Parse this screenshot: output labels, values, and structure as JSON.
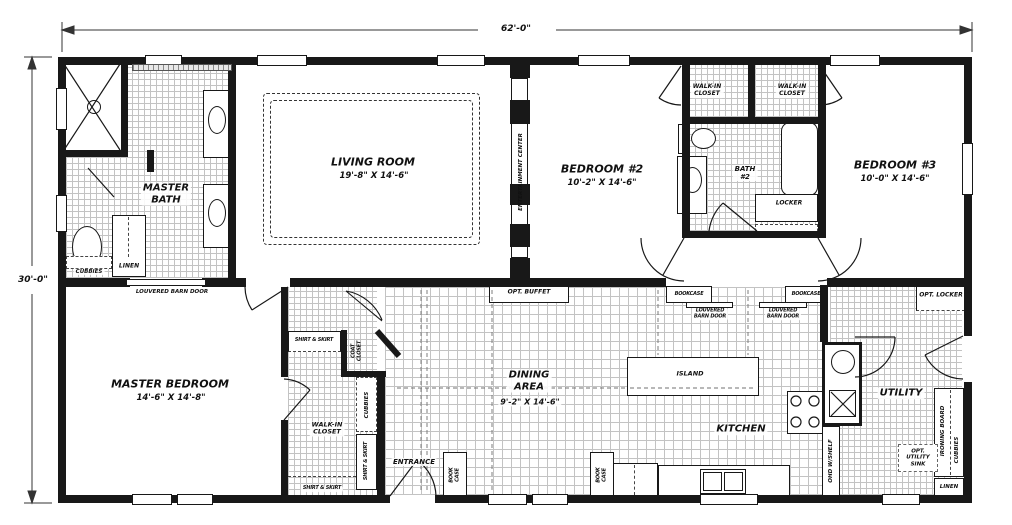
{
  "dimensions": {
    "width": "62'-0\"",
    "depth": "30'-0\""
  },
  "rooms": {
    "living": {
      "name": "LIVING ROOM",
      "size": "19'-8\" X 14'-6\""
    },
    "master_bedroom": {
      "name": "MASTER BEDROOM",
      "size": "14'-6\" X 14'-8\""
    },
    "bedroom2": {
      "name": "BEDROOM #2",
      "size": "10'-2\" X 14'-6\""
    },
    "bedroom3": {
      "name": "BEDROOM #3",
      "size": "10'-0\" X 14'-6\""
    },
    "dining": {
      "name": "DINING\nAREA",
      "size": "9'-2\" X 14'-6\""
    },
    "kitchen": {
      "name": "KITCHEN"
    },
    "utility": {
      "name": "UTILITY"
    },
    "master_bath": {
      "name": "MASTER\nBATH"
    },
    "bath2": {
      "name": "BATH\n#2"
    },
    "entrance": {
      "name": "ENTRANCE"
    },
    "walk_in_closet": {
      "name": "WALK-IN\nCLOSET"
    }
  },
  "features": {
    "entertainment_center": "ENTERTAINMENT CENTER",
    "louvered_barn_door": "LOUVERED BARN DOOR",
    "louvered_barn_door_2line": "LOUVERED\nBARN DOOR",
    "bookcase": "BOOKCASE",
    "bookcase_2line": "BOOK\nCASE",
    "opt_buffet": "OPT. BUFFET",
    "opt_locker": "OPT. LOCKER",
    "locker": "LOCKER",
    "island": "ISLAND",
    "cubbies": "CUBBIES",
    "linen": "LINEN",
    "shirt_skirt": "SHIRT & SKIRT",
    "coat_closet": "COAT\nCLOSET",
    "ohd_shelf": "OHD W/SHELF",
    "opt_utility_sink": "OPT.\nUTILITY\nSINK",
    "ironing_board": "IRONING BOARD"
  }
}
